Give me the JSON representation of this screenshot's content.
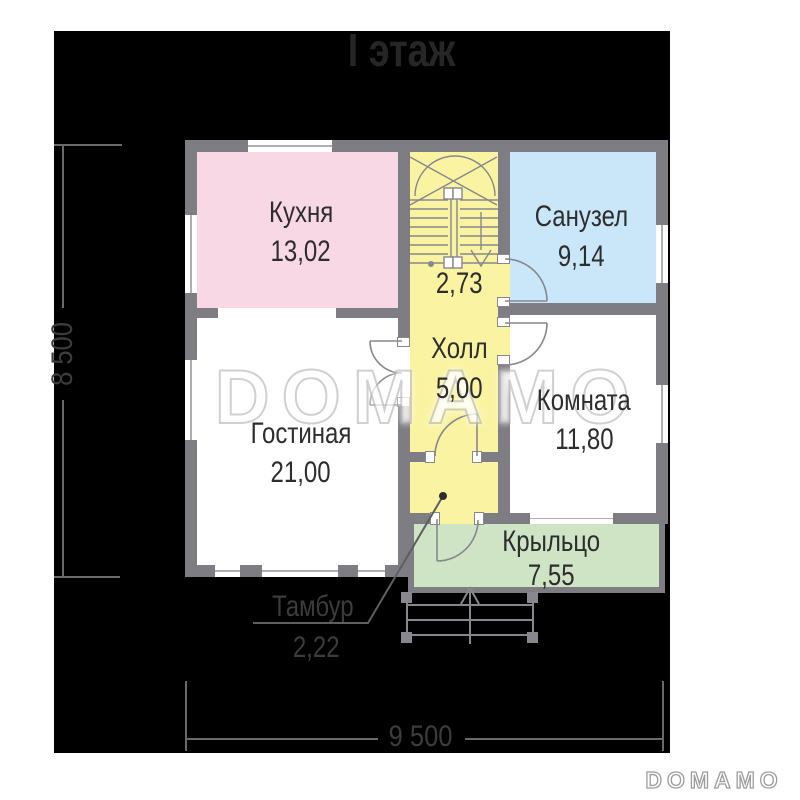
{
  "title": "I этаж",
  "floor_plan": {
    "rooms": {
      "kitchen": {
        "label": "Кухня",
        "area": "13,02"
      },
      "bathroom": {
        "label": "Санузел",
        "area": "9,14"
      },
      "living_room": {
        "label": "Гостиная",
        "area": "21,00"
      },
      "room": {
        "label": "Комната",
        "area": "11,80"
      },
      "hall": {
        "label": "Холл",
        "area": "5,00"
      },
      "stair_landing": {
        "area": "2,73"
      },
      "vestibule": {
        "label": "Тамбур",
        "area": "2,22"
      },
      "porch": {
        "label": "Крыльцо",
        "area": "7,55"
      }
    },
    "dimensions": {
      "overall_width": "9 500",
      "overall_height": "8 500"
    }
  },
  "watermark": "DOMAMO",
  "brand_logo": "DOMAMO",
  "colors": {
    "page_background": "#ffffff",
    "plan_background": "#000000",
    "wall": "#7d7d83",
    "kitchen": "#f8d8e5",
    "bathroom": "#c9e7f8",
    "hall": "#faf4a2",
    "porch": "#cfe3c5",
    "linework": "#87878d"
  }
}
